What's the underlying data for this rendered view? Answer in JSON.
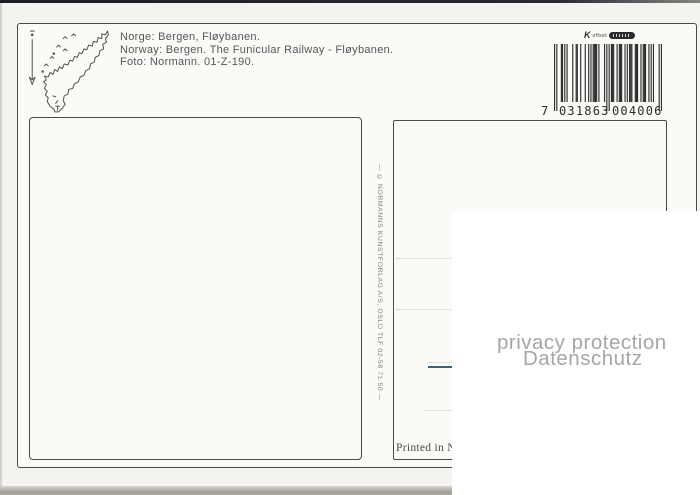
{
  "postcard": {
    "title_lines": {
      "norwegian": "Norge: Bergen, Fløybanen.",
      "english": "Norway: Bergen. The Funicular Railway - Fløybanen.",
      "photo_credit": "Foto: Normann. 01-Z-190."
    },
    "publisher_spine": "— © NORMANNS KUNSTFORLAG A/S, OSLO TLF 02-58 71 50 —",
    "printed_in": "Printed in N",
    "printer_logo_label": "offset"
  },
  "barcode": {
    "value": "7031863004006",
    "human": {
      "first": "7",
      "left": "031863",
      "right": "004006"
    }
  },
  "privacy_watermark": {
    "line1": "privacy protection",
    "line2": "Datenschutz"
  },
  "colors": {
    "paper": "#fbfaf7",
    "scan-bg": "#f4f3ef",
    "frame-line": "#4a4a4a",
    "ink": "#55565a",
    "barcode-ink": "#2d2d2d",
    "dotted-line": "#c9c9c9",
    "pen-accent": "#3f6070",
    "watermark": "#a6a6a6"
  }
}
